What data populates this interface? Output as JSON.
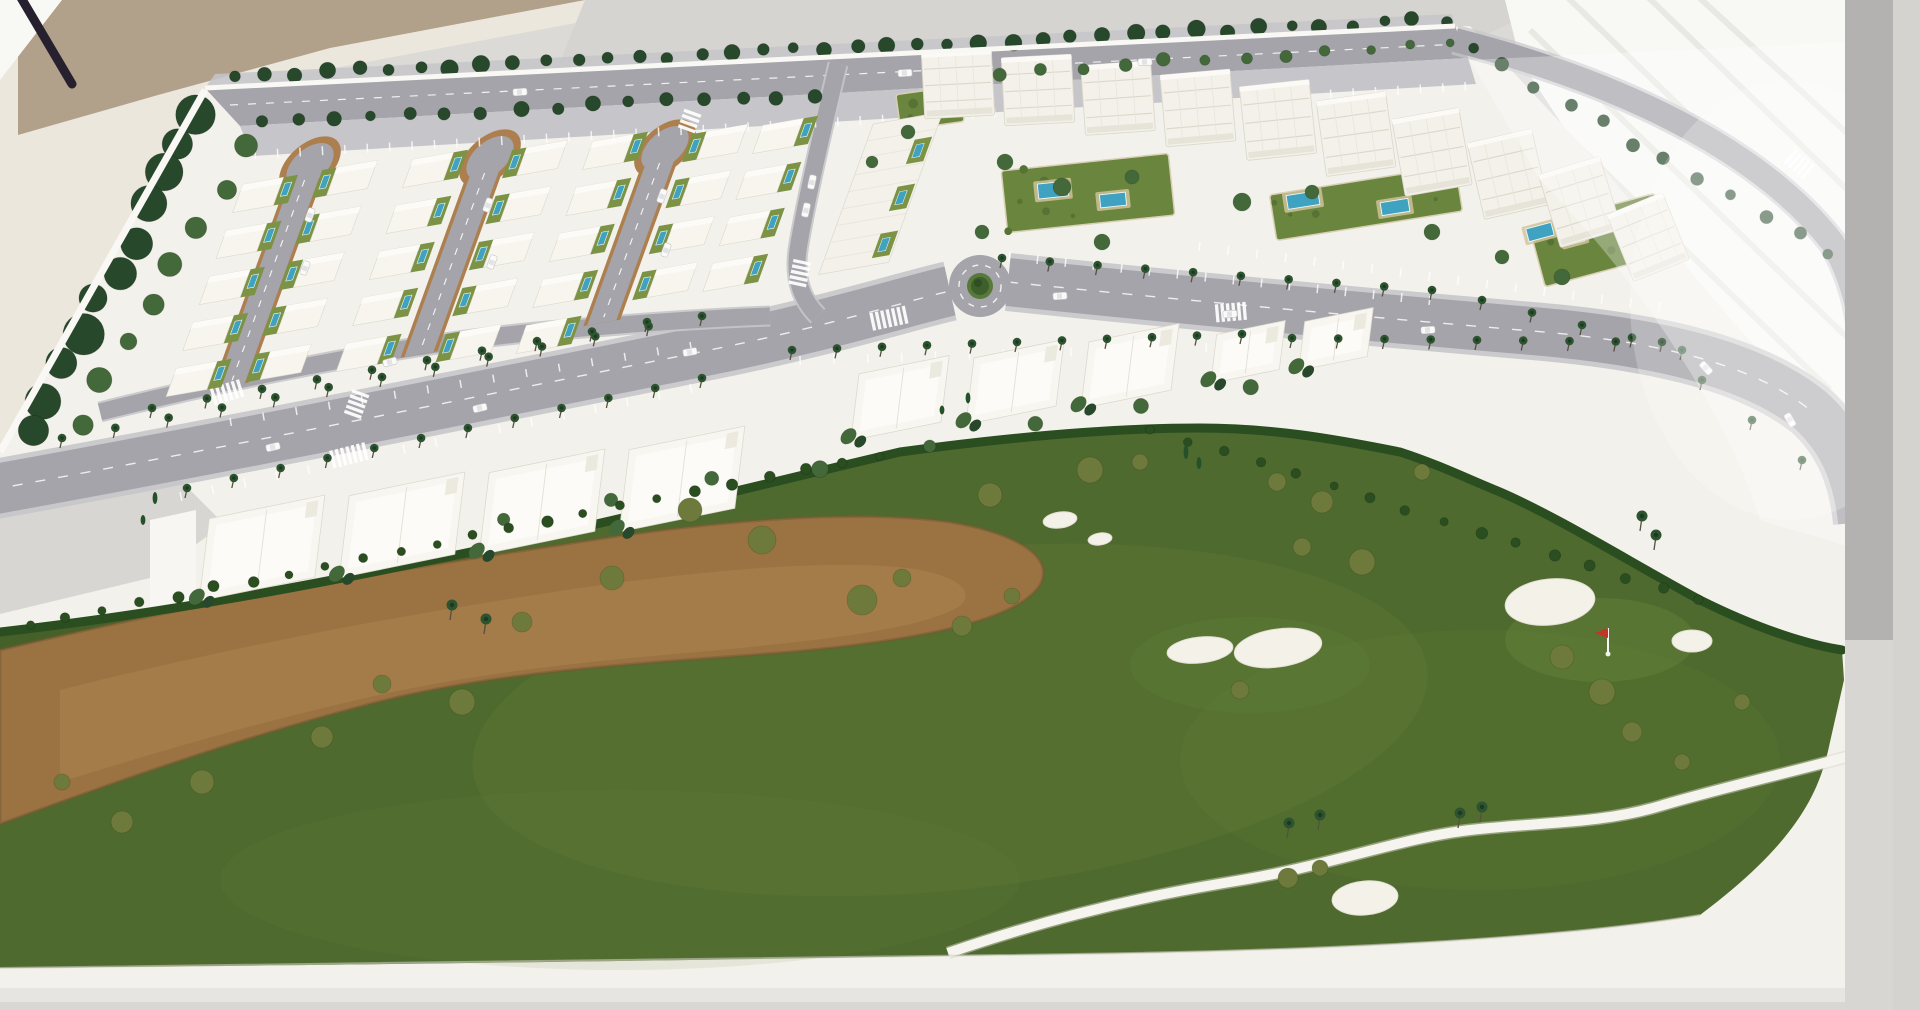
{
  "meta": {
    "description": "Photograph of a physical architectural scale model: a resort residential masterplan with villa blocks around three cul-de-sac loop streets, white apartment buildings with garden pools, a palm-lined boulevard with a roundabout, white townhouse rows, and a golf course with sand bunkers, a dry sandy waste area, a white cart path and a red pin flag. The model sits on a white base in a bright room.",
    "scene_type": "architectural-model-photo"
  },
  "palette": {
    "floor": "#dcdad7",
    "creamWall": "#ece7dd",
    "beigeWall": "#b1a08a",
    "grayWall": "#d6d4d1",
    "windowBright": "#f8f8f5",
    "windowStripe": "#e9e9e3",
    "grayBar": "#b3b2b0",
    "graySliver": "#d5d3d0",
    "rod": "#27212f",
    "base": "#f3f1eb",
    "baseShade": "#e7e5e1",
    "baseEdge": "#f9f8f4",
    "padGray": "#d8d6d2",
    "brightPanel": "#f7f6f3",
    "golf": "#4f6a2e",
    "golfLight": "#6d8a3c",
    "golfDark": "#2f4a1e",
    "greenPutting": "#61803a",
    "waste": "#9b7342",
    "wasteLight": "#ab8351",
    "wasteRim": "#755731",
    "hedge": "#2a4e20",
    "bunker": "#f4f1e9",
    "path": "#f6f4ee",
    "road": "#a4a4aa",
    "roadLight": "#c6c6ca",
    "roadMark": "#ffffff",
    "curb": "#ad7f4e",
    "lawn": "#7c9346",
    "garden": "#69853e",
    "gardenDark": "#567334",
    "deck": "#d4c49c",
    "pool": "#3ea2c0",
    "poolRim": "#eef7f8",
    "villaWhite": "#f7f5ee",
    "aptWhite": "#f3f1e9",
    "thWhite": "#f8f6f0",
    "bldgLine": "#dcd8cb",
    "bldgLineSoft": "#e8e5da",
    "treeDark": "#27482a",
    "treeMid": "#43693a",
    "olive": "#6d7a3c",
    "palm": "#2d5330",
    "palmDark": "#1c3b1e",
    "trunk": "#56503f",
    "carWhite": "#fafaf8",
    "carLine": "#c6c6ca",
    "flagRed": "#c93226",
    "flagPole": "#f5f5f5"
  },
  "scene": {
    "tree_rows": [
      {
        "from": [
          235,
          76
        ],
        "to": [
          1445,
          20
        ],
        "n": 40,
        "r": [
          5,
          9
        ],
        "color": "treeDark",
        "jitter": 3
      },
      {
        "from": [
          262,
          124
        ],
        "to": [
          815,
          94
        ],
        "n": 16,
        "r": [
          5,
          8
        ],
        "color": "treeDark",
        "jitter": 3
      },
      {
        "from": [
          1000,
          72
        ],
        "to": [
          1450,
          44
        ],
        "n": 12,
        "r": [
          4,
          7
        ],
        "color": "treeMid",
        "jitter": 3
      },
      {
        "from": [
          1470,
          48
        ],
        "to": [
          1830,
          255
        ],
        "n": 12,
        "r": [
          5,
          8
        ],
        "color": "treeDark",
        "jitter": 4
      },
      {
        "from": [
          200,
          112
        ],
        "to": [
          30,
          428
        ],
        "n": 11,
        "r": [
          13,
          21
        ],
        "color": "treeDark",
        "jitter": 6
      },
      {
        "from": [
          245,
          150
        ],
        "to": [
          80,
          420
        ],
        "n": 8,
        "r": [
          8,
          13
        ],
        "color": "treeMid",
        "jitter": 6
      },
      {
        "from": [
          500,
          520
        ],
        "to": [
          1250,
          390
        ],
        "n": 8,
        "r": [
          6,
          9
        ],
        "color": "treeMid",
        "jitter": 5
      },
      {
        "from": [
          30,
          625
        ],
        "to": [
          880,
          455
        ],
        "n": 24,
        "r": [
          4,
          6
        ],
        "color": "hedge",
        "jitter": 2
      },
      {
        "from": [
          1150,
          430
        ],
        "to": [
          1700,
          600
        ],
        "n": 16,
        "r": [
          4,
          6
        ],
        "color": "hedge",
        "jitter": 2
      }
    ],
    "tree_clusters": [
      {
        "color": "olive",
        "items": [
          [
            690,
            510,
            12
          ],
          [
            762,
            540,
            14
          ],
          [
            862,
            600,
            15
          ],
          [
            902,
            578,
            9
          ],
          [
            612,
            578,
            12
          ],
          [
            522,
            622,
            10
          ],
          [
            462,
            702,
            13
          ],
          [
            382,
            684,
            9
          ],
          [
            322,
            737,
            11
          ],
          [
            202,
            782,
            12
          ],
          [
            122,
            822,
            11
          ],
          [
            62,
            782,
            8
          ],
          [
            962,
            626,
            10
          ],
          [
            1012,
            596,
            8
          ],
          [
            1090,
            470,
            13
          ],
          [
            990,
            495,
            12
          ],
          [
            1140,
            462,
            8
          ]
        ]
      },
      {
        "color": "olive",
        "items": [
          [
            1562,
            657,
            12
          ],
          [
            1602,
            692,
            13
          ],
          [
            1632,
            732,
            10
          ],
          [
            1682,
            762,
            8
          ],
          [
            1277,
            482,
            9
          ],
          [
            1322,
            502,
            11
          ],
          [
            1422,
            472,
            8
          ],
          [
            1362,
            562,
            13
          ],
          [
            1302,
            547,
            9
          ],
          [
            1742,
            702,
            8
          ],
          [
            1240,
            690,
            9
          ],
          [
            1288,
            878,
            10
          ],
          [
            1320,
            868,
            8
          ]
        ]
      },
      {
        "color": "treeMid",
        "items": [
          [
            1005,
            162,
            8
          ],
          [
            1062,
            187,
            9
          ],
          [
            1132,
            177,
            7
          ],
          [
            1242,
            202,
            9
          ],
          [
            1312,
            192,
            7
          ],
          [
            1432,
            232,
            8
          ],
          [
            1502,
            257,
            7
          ],
          [
            1562,
            277,
            8
          ],
          [
            982,
            232,
            7
          ],
          [
            1102,
            242,
            8
          ],
          [
            908,
            132,
            7
          ],
          [
            872,
            162,
            6
          ]
        ]
      }
    ],
    "cypresses": [
      [
        1186,
        452,
        14
      ],
      [
        1199,
        463,
        12
      ],
      [
        968,
        398,
        11
      ],
      [
        942,
        410,
        9
      ],
      [
        155,
        498,
        12
      ],
      [
        143,
        520,
        10
      ]
    ],
    "palm_rows": [
      {
        "from": [
          60,
          448
        ],
        "to": [
          700,
          326
        ],
        "n": 13
      },
      {
        "from": [
          150,
          418
        ],
        "to": [
          645,
          332
        ],
        "n": 10
      },
      {
        "from": [
          185,
          498
        ],
        "to": [
          700,
          388
        ],
        "n": 12
      },
      {
        "from": [
          790,
          360
        ],
        "to": [
          1240,
          344
        ],
        "n": 11
      },
      {
        "from": [
          1290,
          348
        ],
        "to": [
          1660,
          352
        ],
        "n": 9
      },
      {
        "from": [
          1000,
          268
        ],
        "to": [
          1430,
          300
        ],
        "n": 10
      },
      {
        "from": [
          1480,
          310
        ],
        "to": [
          1680,
          360
        ],
        "n": 5
      },
      {
        "from": [
          1700,
          390
        ],
        "to": [
          1800,
          470
        ],
        "n": 3
      }
    ],
    "golf_palms": [
      [
        1287,
        838
      ],
      [
        1318,
        830
      ],
      [
        1458,
        828
      ],
      [
        1480,
        822
      ],
      [
        450,
        620
      ],
      [
        484,
        634
      ],
      [
        1640,
        531
      ],
      [
        1654,
        550
      ]
    ],
    "villa_rows": [
      {
        "x": 258,
        "y": 195,
        "n": 5,
        "side": 1
      },
      {
        "x": 352,
        "y": 178,
        "n": 5,
        "side": -1
      },
      {
        "x": 428,
        "y": 170,
        "n": 5,
        "side": 1
      },
      {
        "x": 542,
        "y": 158,
        "n": 5,
        "side": -1
      },
      {
        "x": 608,
        "y": 152,
        "n": 5,
        "side": 1
      },
      {
        "x": 722,
        "y": 142,
        "n": 4,
        "side": -1
      },
      {
        "x": 778,
        "y": 136,
        "n": 4,
        "side": 1
      }
    ],
    "loops": [
      {
        "x": 310,
        "y": 165,
        "len": 235
      },
      {
        "x": 490,
        "y": 158,
        "len": 209
      },
      {
        "x": 665,
        "y": 148,
        "len": 186
      }
    ],
    "apartments": [
      {
        "x": 958,
        "y": 84,
        "w": 70,
        "h": 66,
        "rot": -3
      },
      {
        "x": 1038,
        "y": 90,
        "w": 70,
        "h": 68,
        "rot": -3
      },
      {
        "x": 1118,
        "y": 98,
        "w": 70,
        "h": 70,
        "rot": -4
      },
      {
        "x": 1198,
        "y": 108,
        "w": 70,
        "h": 72,
        "rot": -5
      },
      {
        "x": 1278,
        "y": 120,
        "w": 70,
        "h": 74,
        "rot": -6
      },
      {
        "x": 1356,
        "y": 134,
        "w": 70,
        "h": 76,
        "rot": -8
      },
      {
        "x": 1432,
        "y": 152,
        "w": 68,
        "h": 78,
        "rot": -10
      },
      {
        "x": 1508,
        "y": 174,
        "w": 66,
        "h": 78,
        "rot": -13
      },
      {
        "x": 1580,
        "y": 202,
        "w": 64,
        "h": 76,
        "rot": -17
      },
      {
        "x": 1648,
        "y": 237,
        "w": 60,
        "h": 72,
        "rot": -22
      }
    ],
    "terrace": {
      "x": 908,
      "y": 118,
      "w": 72,
      "h": 160
    },
    "gardens": [
      {
        "x": 1088,
        "y": 193,
        "w": 168,
        "h": 62,
        "rot": -6
      },
      {
        "x": 1366,
        "y": 203,
        "w": 188,
        "h": 46,
        "rot": -9
      },
      {
        "x": 1600,
        "y": 240,
        "w": 130,
        "h": 62,
        "rot": -15
      },
      {
        "x": 930,
        "y": 108,
        "w": 64,
        "h": 36,
        "rot": -8
      }
    ],
    "pools": [
      {
        "x": 1053,
        "y": 190,
        "w": 30,
        "h": 15,
        "rot": -6
      },
      {
        "x": 1113,
        "y": 200,
        "w": 26,
        "h": 13,
        "rot": -6
      },
      {
        "x": 1303,
        "y": 200,
        "w": 32,
        "h": 14,
        "rot": -9
      },
      {
        "x": 1395,
        "y": 207,
        "w": 28,
        "h": 13,
        "rot": -9
      },
      {
        "x": 1540,
        "y": 232,
        "w": 26,
        "h": 13,
        "rot": -15
      },
      {
        "x": 1574,
        "y": 238,
        "w": 20,
        "h": 11,
        "rot": -15
      }
    ],
    "townhouse_rows": [
      {
        "x": 262,
        "y": 548,
        "dx": 140,
        "dy": -23,
        "n": 4,
        "w": 118,
        "h": 84
      },
      {
        "x": 900,
        "y": 398,
        "dx": 115,
        "dy": -16,
        "n": 3,
        "w": 92,
        "h": 68
      },
      {
        "x": 1248,
        "y": 352,
        "dx": 88,
        "dy": -13,
        "n": 2,
        "w": 70,
        "h": 50
      }
    ],
    "bunkers": [
      {
        "x": 1200,
        "y": 650,
        "rx": 33,
        "ry": 13,
        "rot": -6
      },
      {
        "x": 1278,
        "y": 648,
        "rx": 44,
        "ry": 19,
        "rot": -8
      },
      {
        "x": 1550,
        "y": 602,
        "rx": 45,
        "ry": 23,
        "rot": -6
      },
      {
        "x": 1692,
        "y": 641,
        "rx": 20,
        "ry": 11,
        "rot": 0
      },
      {
        "x": 1365,
        "y": 898,
        "rx": 33,
        "ry": 17,
        "rot": -5
      },
      {
        "x": 1060,
        "y": 520,
        "rx": 17,
        "ry": 8,
        "rot": -8
      },
      {
        "x": 1100,
        "y": 539,
        "rx": 12,
        "ry": 6,
        "rot": -8
      }
    ],
    "cars": [
      {
        "x": 310,
        "y": 215,
        "rot": -70
      },
      {
        "x": 305,
        "y": 268,
        "rot": -70
      },
      {
        "x": 488,
        "y": 205,
        "rot": -70
      },
      {
        "x": 492,
        "y": 262,
        "rot": -70
      },
      {
        "x": 662,
        "y": 196,
        "rot": -70
      },
      {
        "x": 666,
        "y": 250,
        "rot": -70
      },
      {
        "x": 273,
        "y": 447,
        "rot": -13
      },
      {
        "x": 480,
        "y": 408,
        "rot": -13
      },
      {
        "x": 690,
        "y": 352,
        "rot": -10
      },
      {
        "x": 1060,
        "y": 296,
        "rot": -4
      },
      {
        "x": 1230,
        "y": 314,
        "rot": -4
      },
      {
        "x": 1428,
        "y": 330,
        "rot": -3
      },
      {
        "x": 390,
        "y": 362,
        "rot": -15
      },
      {
        "x": 806,
        "y": 210,
        "rot": -78
      },
      {
        "x": 812,
        "y": 182,
        "rot": -78
      },
      {
        "x": 520,
        "y": 92,
        "rot": -3
      },
      {
        "x": 905,
        "y": 73,
        "rot": -3
      },
      {
        "x": 1145,
        "y": 62,
        "rot": -2
      },
      {
        "x": 1790,
        "y": 420,
        "rot": 60
      },
      {
        "x": 1706,
        "y": 368,
        "rot": 48
      }
    ],
    "crosswalks": [
      {
        "x": 228,
        "y": 392,
        "rot": -17,
        "n": 6
      },
      {
        "x": 350,
        "y": 455,
        "rot": -14,
        "n": 7
      },
      {
        "x": 357,
        "y": 403,
        "rot": -70,
        "n": 5
      },
      {
        "x": 890,
        "y": 318,
        "rot": -12,
        "n": 7
      },
      {
        "x": 800,
        "y": 272,
        "rot": -78,
        "n": 5
      },
      {
        "x": 1800,
        "y": 165,
        "rot": 40,
        "n": 5
      },
      {
        "x": 690,
        "y": 120,
        "rot": -70,
        "n": 4
      },
      {
        "x": 1232,
        "y": 312,
        "rot": -5,
        "n": 6
      }
    ],
    "tick_rows": [
      {
        "from": [
          255,
          150
        ],
        "to": [
          1465,
          82
        ],
        "n": 55,
        "len": 9
      },
      {
        "from": [
          180,
          492
        ],
        "to": [
          690,
          384
        ],
        "n": 17,
        "len": 9
      },
      {
        "from": [
          800,
          356
        ],
        "to": [
          1240,
          342
        ],
        "n": 14,
        "len": 9
      },
      {
        "from": [
          1010,
          252
        ],
        "to": [
          1430,
          296
        ],
        "n": 16,
        "len": 9
      },
      {
        "from": [
          1200,
          242
        ],
        "to": [
          1660,
          302
        ],
        "n": 17,
        "len": 9
      },
      {
        "from": [
          230,
          418
        ],
        "to": [
          690,
          342
        ],
        "n": 15,
        "len": 8
      }
    ],
    "flag": {
      "x": 1608,
      "y": 652
    },
    "roundabout": {
      "x": 980,
      "y": 286
    }
  }
}
